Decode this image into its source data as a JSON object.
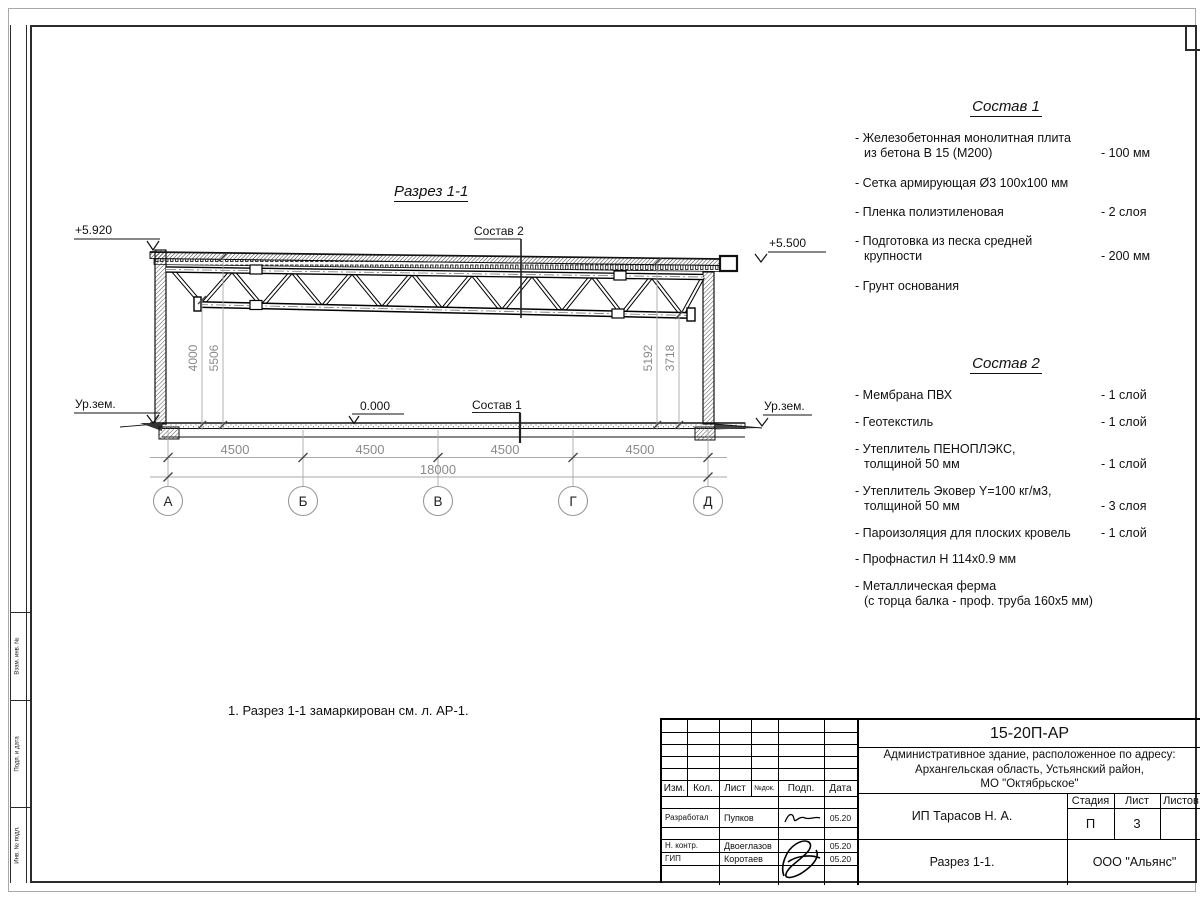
{
  "drawing": {
    "title": "Разрез 1-1",
    "elev_left_top": "+5.920",
    "elev_right_top": "+5.500",
    "ground_left": "Ур.зем.",
    "ground_right": "Ур.зем.",
    "zero": "0.000",
    "comp1_label": "Состав 1",
    "comp2_label": "Состав 2",
    "dims_left": [
      "4000",
      "5506"
    ],
    "dims_right": [
      "5192",
      "3718"
    ],
    "dims_h": [
      "4500",
      "4500",
      "4500",
      "4500"
    ],
    "dim_total": "18000",
    "axes": [
      "А",
      "Б",
      "В",
      "Г",
      "Д"
    ]
  },
  "comp1": {
    "title": "Состав 1",
    "items": [
      {
        "name": "- Железобетонная монолитная плита\nиз бетона В 15 (М200)",
        "qty": "- 100 мм"
      },
      {
        "name": "- Сетка армирующая Ø3 100х100 мм",
        "qty": ""
      },
      {
        "name": "- Пленка полиэтиленовая",
        "qty": "- 2 слоя"
      },
      {
        "name": "- Подготовка из песка средней\nкрупности",
        "qty": "- 200 мм"
      },
      {
        "name": "- Грунт основания",
        "qty": ""
      }
    ]
  },
  "comp2": {
    "title": "Состав 2",
    "items": [
      {
        "name": "- Мембрана ПВХ",
        "qty": "- 1 слой"
      },
      {
        "name": "- Геотекстиль",
        "qty": "- 1 слой"
      },
      {
        "name": "- Утеплитель ПЕНОПЛЭКС,\nтолщиной 50 мм",
        "qty": "- 1 слой"
      },
      {
        "name": "- Утеплитель Эковер Y=100 кг/м3,\nтолщиной 50 мм",
        "qty": "- 3 слоя"
      },
      {
        "name": "- Пароизоляция для плоских кровель",
        "qty": "- 1 слой"
      },
      {
        "name": "- Профнастил Н 114х0.9 мм",
        "qty": ""
      },
      {
        "name": "- Металлическая ферма\n(с торца балка - проф. труба 160х5 мм)",
        "qty": ""
      }
    ]
  },
  "note": "1. Разрез 1-1 замаркирован см. л. АР-1.",
  "titleblock": {
    "doc_number": "15-20П-АР",
    "project": "Административное здание, расположенное по адресу:\nАрхангельская область, Устьянский район,\nМО \"Октябрьское\"",
    "client": "ИП Тарасов Н. А.",
    "sheet_title": "Разрез 1-1.",
    "company": "ООО \"Альянс\"",
    "stage_label": "Стадия",
    "sheet_label": "Лист",
    "sheets_label": "Листов",
    "stage": "П",
    "sheet_no": "3",
    "cols": {
      "izm": "Изм.",
      "kol": "Кол.",
      "list": "Лист",
      "ndok": "№док.",
      "podp": "Подп.",
      "data": "Дата"
    },
    "rows": [
      {
        "role": "Разработал",
        "name": "Пупков",
        "date": "05.20"
      },
      {
        "role": "Н. контр.",
        "name": "Двоеглазов",
        "date": "05.20"
      },
      {
        "role": "ГИП",
        "name": "Коротаев",
        "date": "05.20"
      }
    ]
  },
  "side_strip": {
    "labels": [
      "Взам. инв. №",
      "Подп. и дата",
      "Инв. № подл."
    ]
  }
}
